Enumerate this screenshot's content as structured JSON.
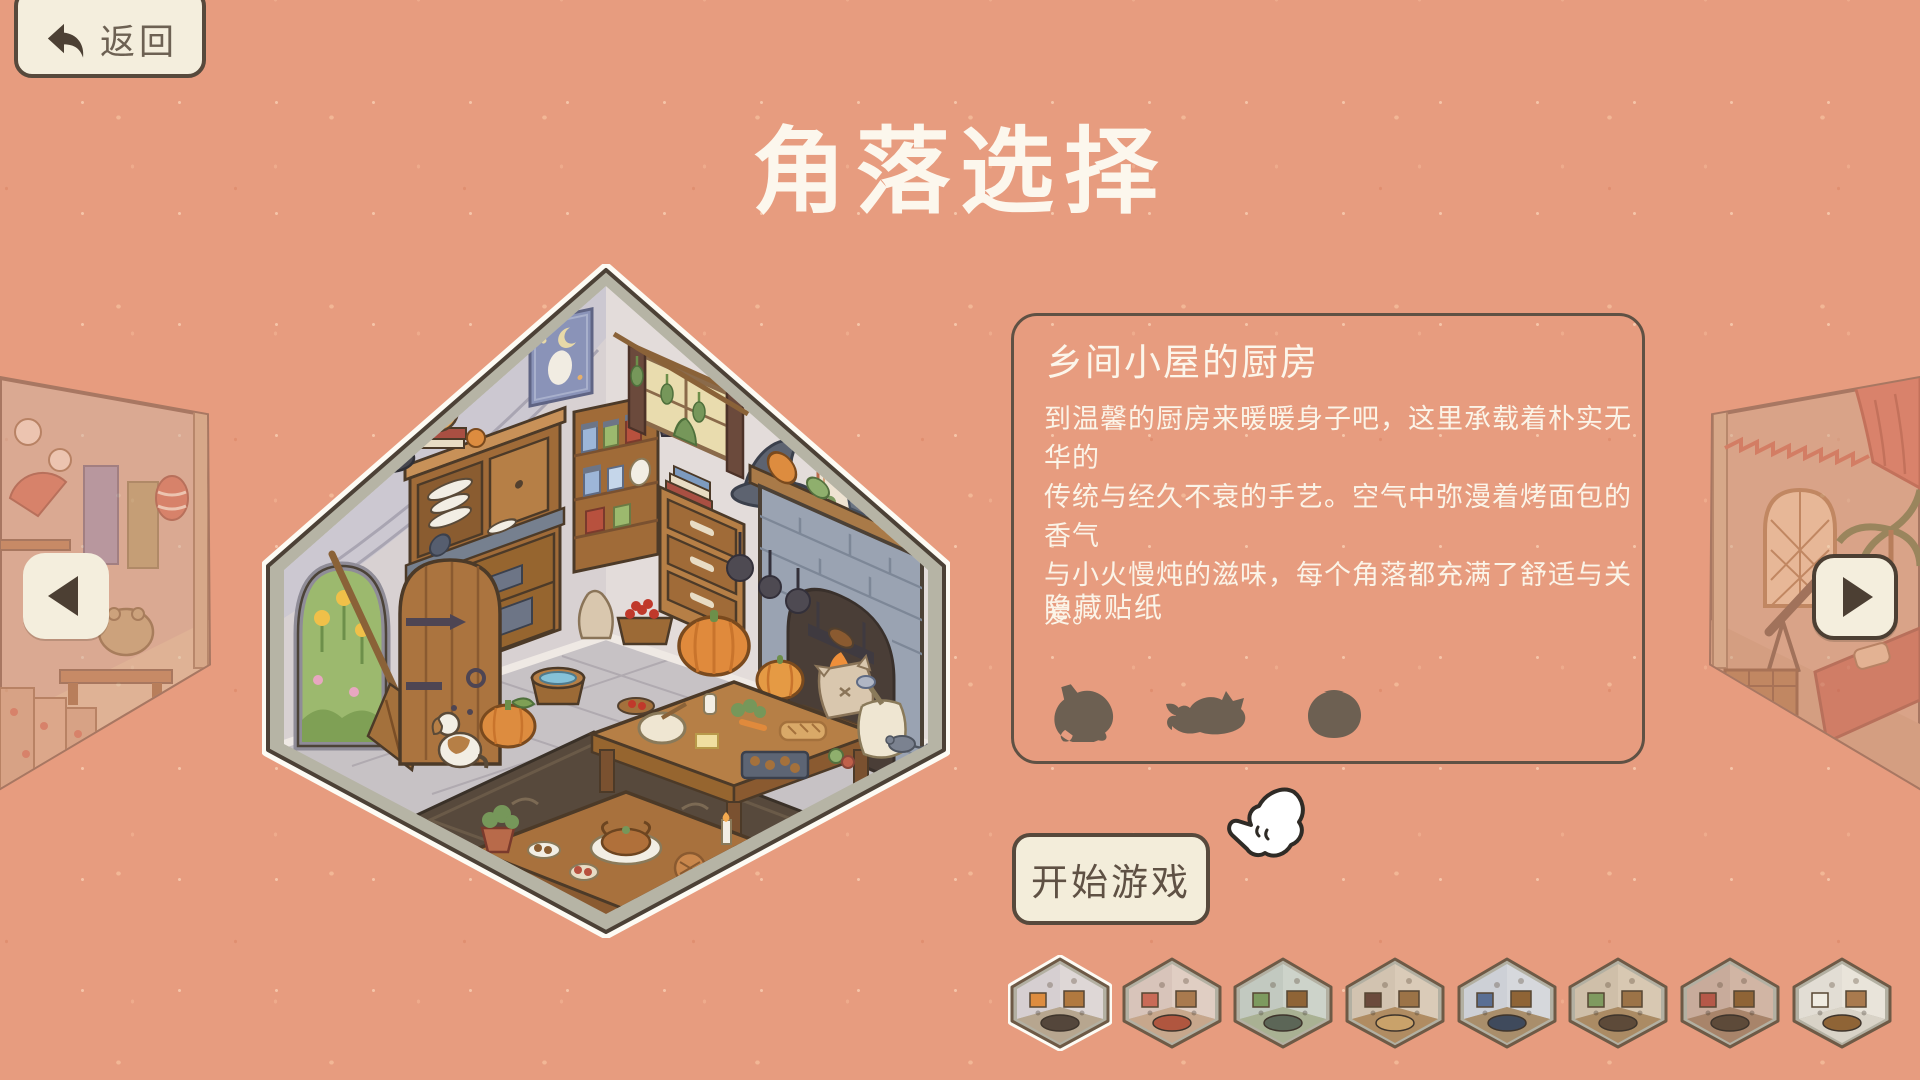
{
  "page_title": "角落选择",
  "back_button": {
    "label": "返回",
    "icon": "back-arrow-icon"
  },
  "carousel": {
    "prev_icon": "left-triangle-icon",
    "next_icon": "right-triangle-icon",
    "left_preview_room": "japanese-tea-room",
    "right_preview_room": "desert-observatory-room"
  },
  "room": {
    "name": "乡间小屋的厨房",
    "style": "cottage-kitchen-isometric"
  },
  "info_panel": {
    "title": "乡间小屋的厨房",
    "description_lines": [
      "到温馨的厨房来暖暖身子吧，这里承载着朴实无华的",
      "传统与经久不衰的手艺。空气中弥漫着烤面包的香气",
      "与小火慢炖的滋味，每个角落都充满了舒适与关爱。"
    ],
    "hidden_stickers_label": "隐藏贴纸",
    "stickers": [
      {
        "name": "sitting-cat-silhouette"
      },
      {
        "name": "crouching-cat-silhouette"
      },
      {
        "name": "round-pot-silhouette"
      }
    ]
  },
  "start_button": {
    "label": "开始游戏"
  },
  "colors": {
    "background": "#e79c7f",
    "panel_border": "#5f5144",
    "text_light": "#fbf4e8",
    "button_bg": "#f3edda",
    "button_border": "#57493c",
    "button_text": "#5f5144",
    "silhouette": "#6d6052",
    "hex_frame": "#b6b4a5",
    "hex_outline": "#4c4136"
  },
  "thumbnails": [
    {
      "id": "country-kitchen",
      "selected": true,
      "colors": {
        "wall_left": "#d6cfd1",
        "wall_right": "#ded7d6",
        "floor": "#b7a68f",
        "accents": [
          "#b1793f",
          "#dd8c3f",
          "#54463b"
        ]
      }
    },
    {
      "id": "red-bedroom",
      "selected": false,
      "colors": {
        "wall_left": "#d8c4ba",
        "wall_right": "#e0cec3",
        "floor": "#c7a78c",
        "accents": [
          "#a97a4e",
          "#c96a57",
          "#b0563f"
        ]
      }
    },
    {
      "id": "overgrown-greenhouse",
      "selected": false,
      "colors": {
        "wall_left": "#c2c9c0",
        "wall_right": "#cdd3ca",
        "floor": "#a9b193",
        "accents": [
          "#8f6436",
          "#7d9a5f",
          "#5c6657"
        ]
      }
    },
    {
      "id": "wooden-attic",
      "selected": false,
      "colors": {
        "wall_left": "#d2c3b0",
        "wall_right": "#dacbb8",
        "floor": "#b08c62",
        "accents": [
          "#9c7347",
          "#6b4a3c",
          "#c9a26a"
        ]
      }
    },
    {
      "id": "alchemist-study",
      "selected": false,
      "colors": {
        "wall_left": "#cdd0d6",
        "wall_right": "#d6d8dc",
        "floor": "#a98e6b",
        "accents": [
          "#8f6436",
          "#5a6f94",
          "#3f4a5c"
        ]
      }
    },
    {
      "id": "craft-workshop",
      "selected": false,
      "colors": {
        "wall_left": "#cfbfa9",
        "wall_right": "#d8c8b2",
        "floor": "#ab8b64",
        "accents": [
          "#9c7347",
          "#7f9a5f",
          "#5d4a39"
        ]
      }
    },
    {
      "id": "festive-parlor",
      "selected": false,
      "colors": {
        "wall_left": "#c8ab9b",
        "wall_right": "#d1b5a4",
        "floor": "#a8846a",
        "accents": [
          "#8f6436",
          "#b55848",
          "#5d4a39"
        ]
      }
    },
    {
      "id": "bright-bathhouse",
      "selected": false,
      "colors": {
        "wall_left": "#e2ddd4",
        "wall_right": "#e9e4da",
        "floor": "#d9d3c7",
        "accents": [
          "#a97a4e",
          "#f0ece2",
          "#8f6436"
        ]
      }
    }
  ]
}
